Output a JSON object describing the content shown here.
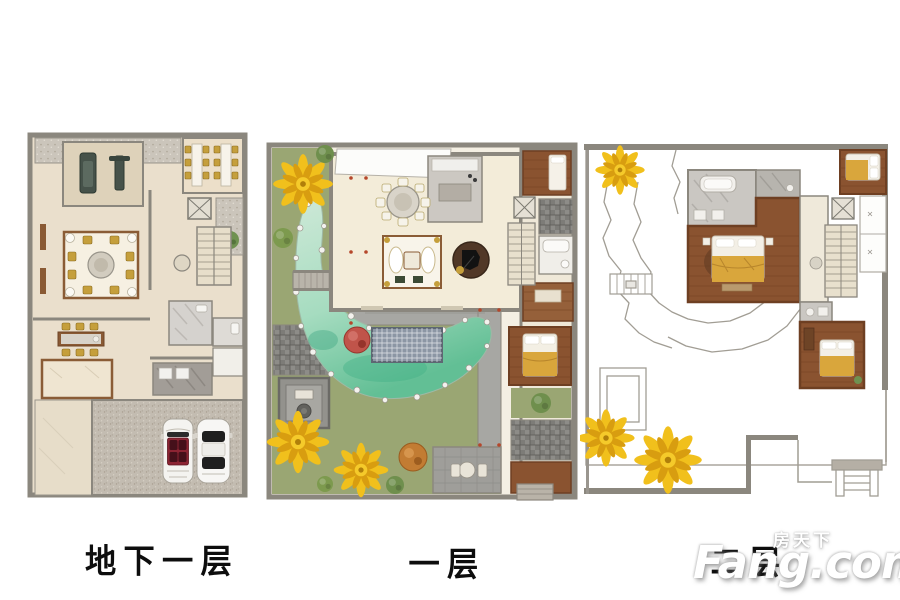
{
  "floorplans": {
    "basement": {
      "label": "地下一层"
    },
    "first": {
      "label": "一层"
    },
    "second": {
      "label": "二层"
    }
  },
  "watermark": {
    "site_name": "房天下",
    "brand": "Fang.com"
  },
  "colors": {
    "background": "#ffffff",
    "wall_gray": "#8b877e",
    "floor_beige": "#eadfcc",
    "wood_brown": "#8a5330",
    "grass_green": "#9aa673",
    "pond_jade": "#62bf95",
    "ginkgo_yellow": "#f1c01c",
    "tree_red": "#c0544a",
    "tree_orange": "#c27c33",
    "gold_furniture": "#c59f3c",
    "bed_gold": "#d9a63c",
    "garage_concrete": "#c3bcb1",
    "label_black": "#0d0d0d",
    "watermark_white": "#ffffff"
  }
}
